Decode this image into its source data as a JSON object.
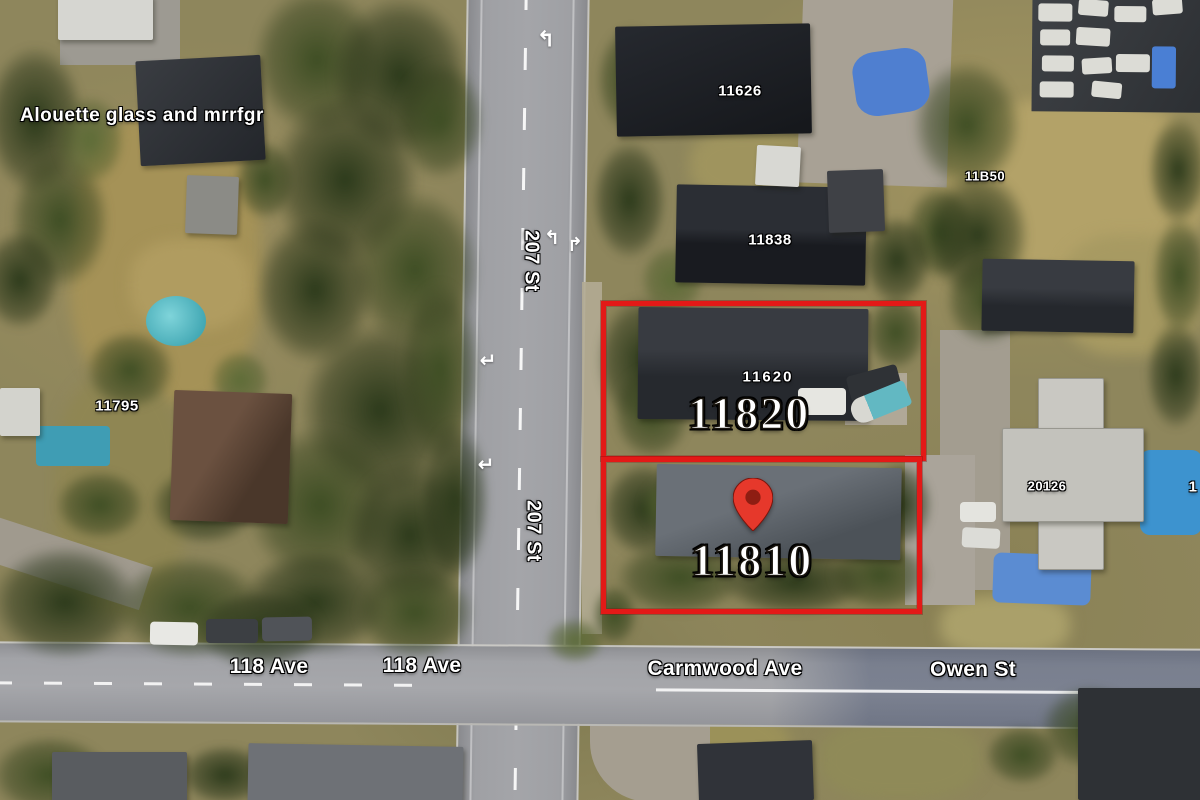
{
  "map": {
    "view_type": "satellite",
    "poi_label": "Alouette glass and mrrfgr",
    "parcels": {
      "outline_color": "#e31917",
      "items": [
        {
          "number": "11820",
          "highlighted": true
        },
        {
          "number": "11810",
          "highlighted": true,
          "has_marker": true
        }
      ]
    },
    "marker": {
      "type": "red-map-pin",
      "fill": "#e6382b",
      "core": "#8e1d12"
    },
    "address_labels": {
      "top_center": "11626",
      "mid_center": "11838",
      "top_right": "11B50",
      "left": "11795",
      "roof_11820": "11620",
      "right": "20126",
      "right_edge_partial": "1"
    },
    "street_labels": {
      "st207_upper": "207 St",
      "st207_lower": "207 St",
      "ave118_west": "118 Ave",
      "ave118_east": "118 Ave",
      "carmwood": "Carmwood Ave",
      "owen": "Owen St"
    },
    "road_markings": {
      "lane_arrows": [
        {
          "glyph": "↰",
          "meaning": "left-turn"
        },
        {
          "glyph": "↰",
          "meaning": "left-turn"
        },
        {
          "glyph": "↱",
          "meaning": "straight-or-right"
        },
        {
          "glyph": "↵",
          "meaning": "left-turn"
        },
        {
          "glyph": "↵",
          "meaning": "left-turn"
        }
      ]
    }
  }
}
